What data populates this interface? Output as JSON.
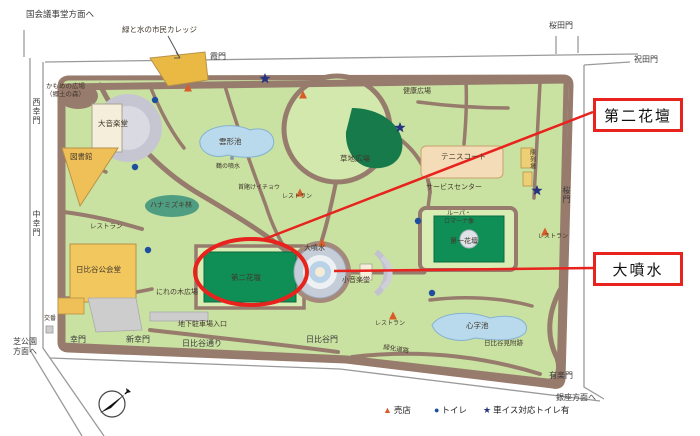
{
  "colors": {
    "annotation_red": "#e8221c",
    "park_green": "#c9e2a2",
    "path_brown": "#977b6c",
    "flowerbed_green": "#0f8f55",
    "water_blue": "#b9d9ec",
    "building_orange": "#f0c058",
    "court_tan": "#f4dcb8",
    "toilet_blue": "#1d4f9e",
    "shop_orange": "#d85c28",
    "wheelchair_blue": "#26337e"
  },
  "callouts": [
    {
      "text": "第二花壇"
    },
    {
      "text": "大噴水"
    }
  ],
  "map": {
    "outer": [
      {
        "text": "国会議事堂方面へ"
      },
      {
        "text": "桜田門"
      },
      {
        "text": "祝田門"
      },
      {
        "text": "霞門"
      },
      {
        "text": "西幸門"
      },
      {
        "text": "中幸門"
      },
      {
        "text": "芝公園\n方面へ"
      },
      {
        "text": "幸門"
      },
      {
        "text": "新幸門"
      },
      {
        "text": "日比谷通り"
      },
      {
        "text": "日比谷門"
      },
      {
        "text": "有楽門"
      },
      {
        "text": "銀座方面へ"
      },
      {
        "text": "桜門"
      }
    ],
    "inner": [
      {
        "text": "緑と水の市民カレッジ"
      },
      {
        "text": "かもめの広場\n（郷土の森）"
      },
      {
        "text": "大音楽堂"
      },
      {
        "text": "図書館"
      },
      {
        "text": "雲形池"
      },
      {
        "text": "鶴の噴水"
      },
      {
        "text": "ハナミズキ林"
      },
      {
        "text": "レストラン"
      },
      {
        "text": "日比谷公会堂"
      },
      {
        "text": "にれの木広場"
      },
      {
        "text": "第二花壇"
      },
      {
        "text": "地下駐車場入口"
      },
      {
        "text": "首賭けイチョウ"
      },
      {
        "text": "レストラン"
      },
      {
        "text": "草地広場"
      },
      {
        "text": "大噴水"
      },
      {
        "text": "小音楽堂"
      },
      {
        "text": "健康広場"
      },
      {
        "text": "テニスコート"
      },
      {
        "text": "サービスセンター"
      },
      {
        "text": "陳列場"
      },
      {
        "text": "ルーパ・\nロマーナ像"
      },
      {
        "text": "第一花壇"
      },
      {
        "text": "レストラン"
      },
      {
        "text": "心字池"
      },
      {
        "text": "日比谷見附跡"
      },
      {
        "text": "緑化道路"
      },
      {
        "text": "レストラン"
      },
      {
        "text": "交番"
      }
    ]
  },
  "legend": {
    "items": [
      {
        "glyph": "▲",
        "label": "売店"
      },
      {
        "glyph": "●",
        "label": "トイレ"
      },
      {
        "glyph": "★",
        "label": "車イス対応トイレ有"
      }
    ]
  }
}
